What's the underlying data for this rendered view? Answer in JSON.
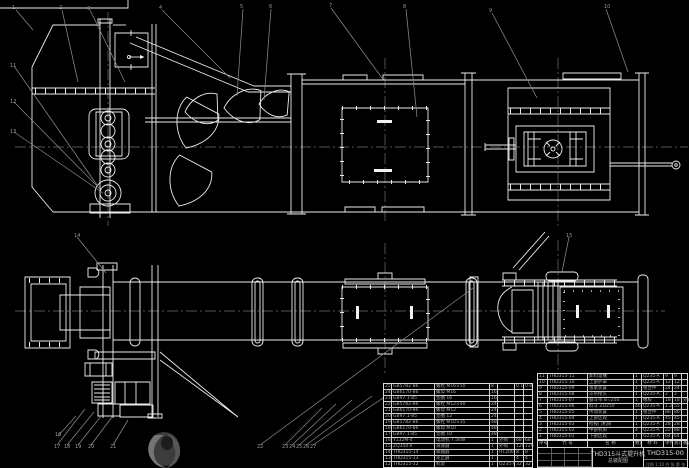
{
  "colors": {
    "background": "#000000",
    "line": "#ededed",
    "dim_gray": "#8a8a8a",
    "table_text": "#adadad"
  },
  "title_block": {
    "title_line1": "THD315斗式提升机",
    "title_line2": "总装配图",
    "drawing_no": "THD315-00",
    "scale_note": "比例 1:10  共 张  第 张"
  },
  "bom_right": {
    "headers": [
      "序号",
      "代 号",
      "名 称",
      "数量",
      "材 料",
      "单件",
      "总计",
      "备注"
    ],
    "rows": [
      [
        "11",
        "THD315-11",
        "卸料溜槽",
        "1",
        "Q235-A",
        "9",
        "9",
        ""
      ],
      [
        "10",
        "THD315-10",
        "上部护罩",
        "1",
        "Q235-A",
        "12",
        "12",
        ""
      ],
      [
        "9",
        "THD315-09",
        "张紧装置",
        "1",
        "组合件",
        "24",
        "24",
        ""
      ],
      [
        "8",
        "THD315-08",
        "斗带接头",
        "1",
        "Q235-A",
        "2",
        "2",
        ""
      ],
      [
        "7",
        "THD315-07",
        "畚斗带 B=250",
        "1",
        "橡胶",
        "18",
        "18",
        "外购"
      ],
      [
        "6",
        "THD315-06",
        "料斗 ZD250",
        "46",
        "Q235-A",
        "1.2",
        "55",
        ""
      ],
      [
        "5",
        "THD315-05",
        "传动装置",
        "1",
        "组合件",
        "86",
        "86",
        ""
      ],
      [
        "4",
        "THD315-04",
        "上部区段",
        "1",
        "Q235-A",
        "45",
        "45",
        ""
      ],
      [
        "3",
        "THD315-03",
        "检视门机筒",
        "1",
        "Q235-A",
        "28",
        "28",
        ""
      ],
      [
        "2",
        "THD315-02",
        "中部机筒",
        "4",
        "Q235-A",
        "22",
        "88",
        ""
      ],
      [
        "1",
        "THD315-01",
        "下部区段",
        "1",
        "Q235-A",
        "64",
        "64",
        ""
      ]
    ]
  },
  "bom_left": {
    "rows": [
      [
        "25",
        "GB5782-86",
        "螺栓 M16×50",
        "8",
        "",
        "0.1",
        "0.8"
      ],
      [
        "24",
        "GB6170-86",
        "螺母 M16",
        "16",
        "",
        "",
        ""
      ],
      [
        "23",
        "GB97.1-85",
        "垫圈 16",
        "16",
        "",
        "",
        ""
      ],
      [
        "22",
        "GB5782-86",
        "螺栓 M12×40",
        "24",
        "",
        "",
        ""
      ],
      [
        "21",
        "GB6170-86",
        "螺母 M12",
        "24",
        "",
        "",
        ""
      ],
      [
        "20",
        "GB97.1-85",
        "垫圈 12",
        "24",
        "",
        "",
        ""
      ],
      [
        "19",
        "GB5782-86",
        "螺栓 M10×35",
        "48",
        "",
        "",
        ""
      ],
      [
        "18",
        "GB6170-86",
        "螺母 M10",
        "48",
        "",
        "",
        ""
      ],
      [
        "17",
        "GB97.1-85",
        "垫圈 10",
        "48",
        "",
        "",
        ""
      ],
      [
        "16",
        "Y132M-4",
        "电动机 7.5kW",
        "1",
        "外购",
        "68",
        "68"
      ],
      [
        "15",
        "ZQ350-Ⅱ",
        "减速器",
        "1",
        "外购",
        "120",
        "120"
      ],
      [
        "14",
        "THD315-14",
        "联轴器",
        "1",
        "HT200",
        "8",
        "8"
      ],
      [
        "13",
        "THD315-13",
        "逆止器",
        "1",
        "",
        "4",
        "4"
      ],
      [
        "12",
        "THD315-12",
        "机架",
        "1",
        "Q235-A",
        "32",
        "32"
      ]
    ]
  },
  "callouts": {
    "top": [
      {
        "n": "1",
        "x": 12,
        "y": 6
      },
      {
        "n": "2",
        "x": 59,
        "y": 6
      },
      {
        "n": "3",
        "x": 87,
        "y": 7
      },
      {
        "n": "4",
        "x": 159,
        "y": 6
      },
      {
        "n": "5",
        "x": 240,
        "y": 5
      },
      {
        "n": "6",
        "x": 269,
        "y": 5
      },
      {
        "n": "7",
        "x": 329,
        "y": 4
      },
      {
        "n": "8",
        "x": 403,
        "y": 5
      },
      {
        "n": "9",
        "x": 489,
        "y": 9
      },
      {
        "n": "10",
        "x": 604,
        "y": 5
      }
    ],
    "left": [
      {
        "n": "11",
        "x": 10,
        "y": 64
      },
      {
        "n": "12",
        "x": 10,
        "y": 100
      },
      {
        "n": "13",
        "x": 10,
        "y": 130
      }
    ],
    "plan": [
      {
        "n": "14",
        "x": 74,
        "y": 234
      },
      {
        "n": "15",
        "x": 566,
        "y": 234
      }
    ],
    "bottom": [
      {
        "n": "16",
        "x": 55,
        "y": 433
      },
      {
        "n": "17",
        "x": 54,
        "y": 445
      },
      {
        "n": "18",
        "x": 64,
        "y": 445
      },
      {
        "n": "19",
        "x": 75,
        "y": 445
      },
      {
        "n": "20",
        "x": 88,
        "y": 445
      },
      {
        "n": "21",
        "x": 110,
        "y": 445
      },
      {
        "n": "22",
        "x": 257,
        "y": 445
      },
      {
        "n": "23",
        "x": 282,
        "y": 445
      },
      {
        "n": "24",
        "x": 289,
        "y": 445
      },
      {
        "n": "25",
        "x": 296,
        "y": 445
      },
      {
        "n": "26",
        "x": 303,
        "y": 445
      },
      {
        "n": "27",
        "x": 310,
        "y": 445
      }
    ]
  }
}
